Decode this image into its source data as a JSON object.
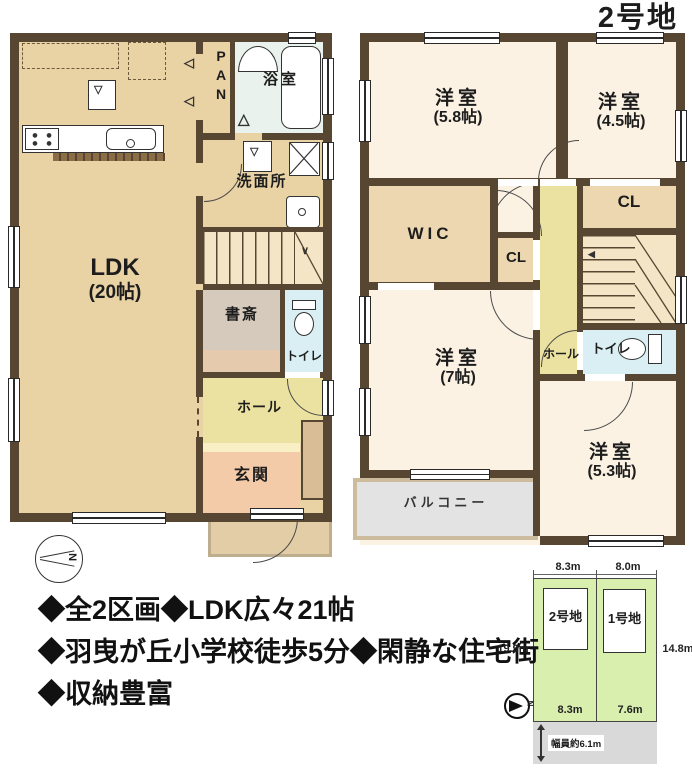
{
  "title": "2号地",
  "floor1": {
    "ldk": {
      "name": "LDK",
      "size": "(20帖)"
    },
    "pantry": "PAN",
    "bath": "浴室",
    "washroom": "洗面所",
    "study": "書斎",
    "toilet": "トイレ",
    "hall": "ホール",
    "entrance": "玄関"
  },
  "floor2": {
    "room_58": {
      "name": "洋室",
      "size": "(5.8帖)"
    },
    "room_45": {
      "name": "洋室",
      "size": "(4.5帖)"
    },
    "wic": "WIC",
    "cl_mid": "CL",
    "cl_right": "CL",
    "hall": "ホール",
    "toilet": "トイレ",
    "room_7": {
      "name": "洋室",
      "size": "(7帖)"
    },
    "room_53": {
      "name": "洋室",
      "size": "(5.3帖)"
    },
    "balcony": "バルコニー"
  },
  "features": [
    "◆全2区画◆LDK広々21帖",
    "◆羽曳が丘小学校徒歩5分◆閑静な住宅街",
    "◆収納豊富"
  ],
  "site_plan": {
    "lot2": "2号地",
    "lot1": "1号地",
    "dim_top_left": "8.3m",
    "dim_top_right": "8.0m",
    "dim_left": "19.9m",
    "dim_right": "14.8m",
    "dim_bottom_left": "8.3m",
    "dim_bottom_right": "7.6m",
    "road_width": "幅員約6.1m"
  },
  "compass_n": "N",
  "colors": {
    "wall": "#574732",
    "ldk_floor": "#e9d2a4",
    "room_floor": "#fbf2e3",
    "hall_floor": "#ebe1a0",
    "entrance_floor": "#f4cba8",
    "toilet_floor": "#d9eff3",
    "bath_floor": "#e9f2ec",
    "closet_floor": "#ecd7b0",
    "balcony_floor": "#e3e3e3",
    "site_green": "#d9efae",
    "road_gray": "#d9d9d9"
  }
}
